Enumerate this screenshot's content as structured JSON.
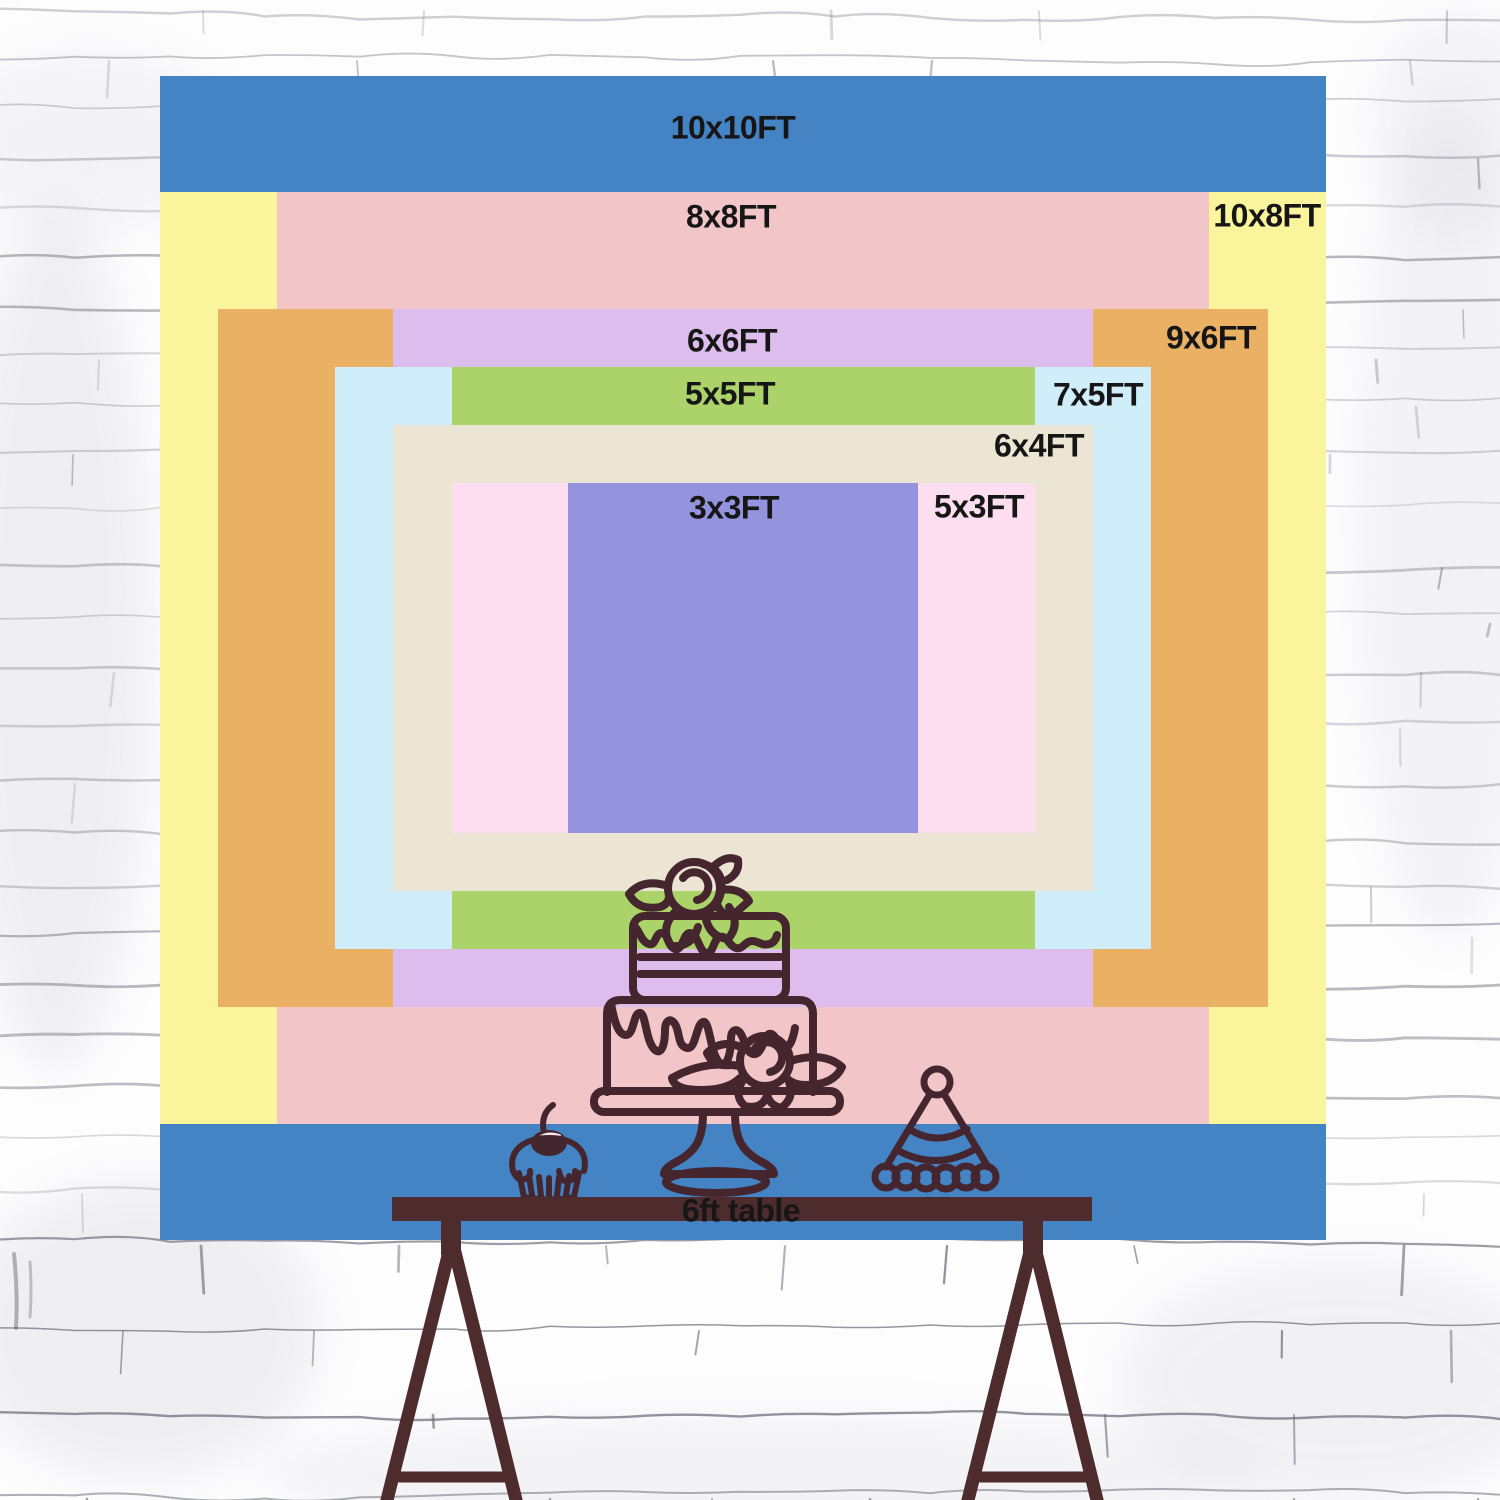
{
  "scene": {
    "width_px": 1500,
    "height_px": 1500,
    "wall": {
      "base_color": "#fdfdfe",
      "mortar_color": "#6f6f7c"
    }
  },
  "backdrop": {
    "unit": "FT",
    "geometry": {
      "px_per_ft_x": 116.6,
      "px_per_ft_y": 116.4,
      "center_x": 743,
      "center_y": 658
    },
    "sizes": [
      {
        "id": "10x10",
        "label": "10x10FT",
        "w_ft": 10,
        "h_ft": 10,
        "color": "#4484c5",
        "label_x": 733,
        "label_y": 128
      },
      {
        "id": "10x8",
        "label": "10x8FT",
        "w_ft": 10,
        "h_ft": 8,
        "color": "#faf49c",
        "label_x": 1267,
        "label_y": 216
      },
      {
        "id": "8x8",
        "label": "8x8FT",
        "w_ft": 8,
        "h_ft": 8,
        "color": "#f2c5c9",
        "label_x": 731,
        "label_y": 217
      },
      {
        "id": "9x6",
        "label": "9x6FT",
        "w_ft": 9,
        "h_ft": 6,
        "color": "#eab165",
        "label_x": 1211,
        "label_y": 338
      },
      {
        "id": "6x6",
        "label": "6x6FT",
        "w_ft": 6,
        "h_ft": 6,
        "color": "#dcbdee",
        "label_x": 732,
        "label_y": 341
      },
      {
        "id": "7x5",
        "label": "7x5FT",
        "w_ft": 7,
        "h_ft": 5,
        "color": "#cfeefa",
        "label_x": 1098,
        "label_y": 395
      },
      {
        "id": "5x5",
        "label": "5x5FT",
        "w_ft": 5,
        "h_ft": 5,
        "color": "#abd369",
        "label_x": 730,
        "label_y": 394
      },
      {
        "id": "6x4",
        "label": "6x4FT",
        "w_ft": 6,
        "h_ft": 4,
        "color": "#ece5d4",
        "label_x": 1039,
        "label_y": 446
      },
      {
        "id": "5x3",
        "label": "5x3FT",
        "w_ft": 5,
        "h_ft": 3,
        "color": "#fcdef0",
        "label_x": 979,
        "label_y": 507
      },
      {
        "id": "3x3",
        "label": "3x3FT",
        "w_ft": 3,
        "h_ft": 3,
        "color": "#9494de",
        "label_x": 734,
        "label_y": 508
      }
    ]
  },
  "table": {
    "label": "6ft table",
    "color": "#4e2b2d",
    "label_x": 741,
    "label_y": 1211
  },
  "illustration": {
    "stroke_color": "#45262e",
    "items": [
      "two-tier-cake",
      "cupcake-with-cherry",
      "party-hat"
    ]
  },
  "text_color": "#161616"
}
